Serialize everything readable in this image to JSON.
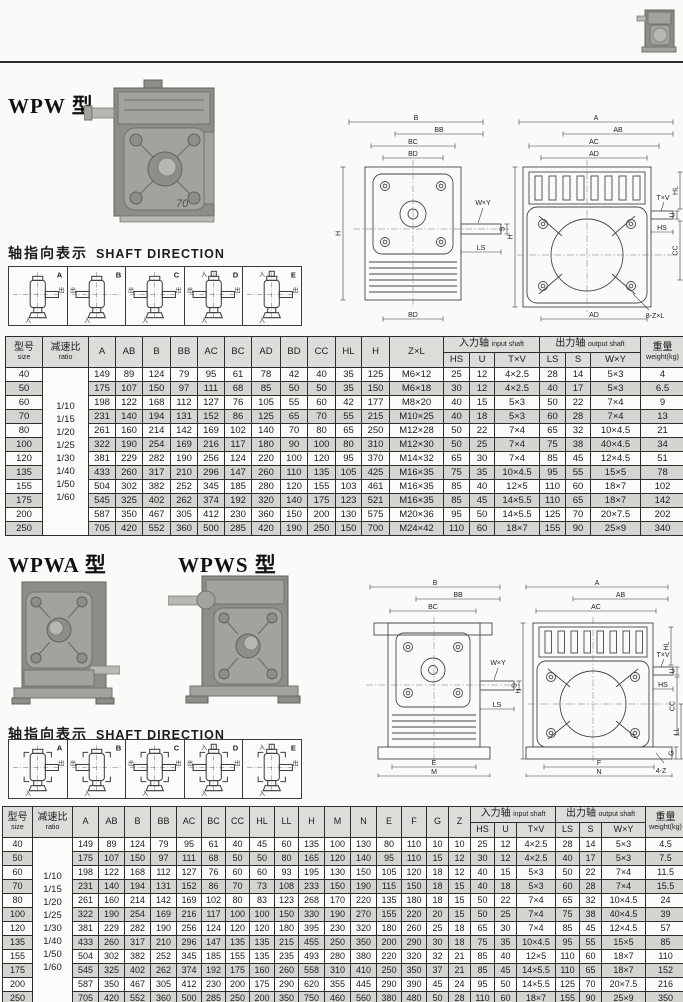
{
  "colors": {
    "paper": "#fafaf8",
    "table_header_bg": "#dcdcd9",
    "row_shaded": "#d4d4d0",
    "line": "#2d2d2d"
  },
  "section1": {
    "title": "WPW 型",
    "photo_badge": "70",
    "shaft_label_cn": "轴指向表示",
    "shaft_label_en": "SHAFT DIRECTION"
  },
  "section2": {
    "title_a": "WPWA 型",
    "title_s": "WPWS 型",
    "shaft_label_cn": "轴指向表示",
    "shaft_label_en": "SHAFT DIRECTION"
  },
  "strips": {
    "in_label": "入",
    "out_label": "出",
    "boxes": [
      {
        "label": "A",
        "out_left": false,
        "out_right": true,
        "in_top": false
      },
      {
        "label": "B",
        "out_left": true,
        "out_right": false,
        "in_top": false
      },
      {
        "label": "C",
        "out_left": true,
        "out_right": true,
        "in_top": false
      },
      {
        "label": "D",
        "out_left": true,
        "out_right": true,
        "in_top": true
      },
      {
        "label": "E",
        "out_left": false,
        "out_right": true,
        "in_top": true
      }
    ]
  },
  "drawing1": {
    "left_dims": [
      "B",
      "BB",
      "BC",
      "BD"
    ],
    "left_bottom": "BD",
    "left_height": "H",
    "shaft_labels": [
      "W×Y",
      "LS",
      "S"
    ],
    "right_dims": [
      "A",
      "AB",
      "AC",
      "AD"
    ],
    "right_bottom": "AD",
    "right_height": "H",
    "input_labels": [
      "T×V",
      "U",
      "HL",
      "HS",
      "CC"
    ],
    "bolt_callout": "8-Z×L"
  },
  "drawing2": {
    "left_dims": [
      "B",
      "BB",
      "BC"
    ],
    "left_base": [
      "E",
      "M"
    ],
    "shaft_labels": [
      "W×Y",
      "LS",
      "S"
    ],
    "right_dims": [
      "A",
      "AB",
      "AC"
    ],
    "right_height": "H",
    "input_labels": [
      "T×V",
      "U",
      "HL",
      "HS",
      "CC"
    ],
    "right_side": [
      "LL",
      "G"
    ],
    "right_base": [
      "F",
      "N"
    ],
    "bolt_callout": "4-Z"
  },
  "table1": {
    "size_header_cn": "型号",
    "size_header_en": "size",
    "ratio_header_cn": "减速比",
    "ratio_header_en": "ratio",
    "col_headers": [
      "A",
      "AB",
      "B",
      "BB",
      "AC",
      "BC",
      "AD",
      "BD",
      "CC",
      "HL",
      "H",
      "Z×L"
    ],
    "input_group_cn": "入力轴",
    "input_group_en": "input shaft",
    "input_cols": [
      "HS",
      "U",
      "T×V"
    ],
    "output_group_cn": "出力轴",
    "output_group_en": "output shaft",
    "output_cols": [
      "LS",
      "S",
      "W×Y"
    ],
    "weight_header_cn": "重量",
    "weight_header_en": "weight(kg)",
    "col_widths": [
      37,
      46,
      27,
      27,
      28,
      27,
      27,
      27,
      29,
      27,
      28,
      26,
      28,
      54,
      26,
      25,
      45,
      26,
      25,
      50,
      44
    ],
    "ratios": [
      "1/10",
      "1/15",
      "1/20",
      "1/25",
      "1/30",
      "1/40",
      "1/50",
      "1/60"
    ],
    "rows": [
      {
        "size": "40",
        "values": [
          "149",
          "89",
          "124",
          "79",
          "95",
          "61",
          "78",
          "42",
          "40",
          "35",
          "125",
          "M6×12",
          "25",
          "12",
          "4×2.5",
          "28",
          "14",
          "5×3",
          "4"
        ]
      },
      {
        "size": "50",
        "values": [
          "175",
          "107",
          "150",
          "97",
          "111",
          "68",
          "85",
          "50",
          "50",
          "35",
          "150",
          "M6×18",
          "30",
          "12",
          "4×2.5",
          "40",
          "17",
          "5×3",
          "6.5"
        ]
      },
      {
        "size": "60",
        "values": [
          "198",
          "122",
          "168",
          "112",
          "127",
          "76",
          "105",
          "55",
          "60",
          "42",
          "177",
          "M8×20",
          "40",
          "15",
          "5×3",
          "50",
          "22",
          "7×4",
          "9"
        ]
      },
      {
        "size": "70",
        "values": [
          "231",
          "140",
          "194",
          "131",
          "152",
          "86",
          "125",
          "65",
          "70",
          "55",
          "215",
          "M10×25",
          "40",
          "18",
          "5×3",
          "60",
          "28",
          "7×4",
          "13"
        ]
      },
      {
        "size": "80",
        "values": [
          "261",
          "160",
          "214",
          "142",
          "169",
          "102",
          "140",
          "70",
          "80",
          "65",
          "250",
          "M12×28",
          "50",
          "22",
          "7×4",
          "65",
          "32",
          "10×4.5",
          "21"
        ]
      },
      {
        "size": "100",
        "values": [
          "322",
          "190",
          "254",
          "169",
          "216",
          "117",
          "180",
          "90",
          "100",
          "80",
          "310",
          "M12×30",
          "50",
          "25",
          "7×4",
          "75",
          "38",
          "40×4.5",
          "34"
        ]
      },
      {
        "size": "120",
        "values": [
          "381",
          "229",
          "282",
          "190",
          "256",
          "124",
          "220",
          "100",
          "120",
          "95",
          "370",
          "M14×32",
          "65",
          "30",
          "7×4",
          "85",
          "45",
          "12×4.5",
          "51"
        ]
      },
      {
        "size": "135",
        "values": [
          "433",
          "260",
          "317",
          "210",
          "296",
          "147",
          "260",
          "110",
          "135",
          "105",
          "425",
          "M16×35",
          "75",
          "35",
          "10×4.5",
          "95",
          "55",
          "15×5",
          "78"
        ]
      },
      {
        "size": "155",
        "values": [
          "504",
          "302",
          "382",
          "252",
          "345",
          "185",
          "280",
          "120",
          "155",
          "103",
          "461",
          "M16×35",
          "85",
          "40",
          "12×5",
          "110",
          "60",
          "18×7",
          "102"
        ]
      },
      {
        "size": "175",
        "values": [
          "545",
          "325",
          "402",
          "262",
          "374",
          "192",
          "320",
          "140",
          "175",
          "123",
          "521",
          "M16×35",
          "85",
          "45",
          "14×5.5",
          "110",
          "65",
          "18×7",
          "142"
        ]
      },
      {
        "size": "200",
        "values": [
          "587",
          "350",
          "467",
          "305",
          "412",
          "230",
          "360",
          "150",
          "200",
          "130",
          "575",
          "M20×36",
          "95",
          "50",
          "14×5.5",
          "125",
          "70",
          "20×7.5",
          "202"
        ]
      },
      {
        "size": "250",
        "values": [
          "705",
          "420",
          "552",
          "360",
          "500",
          "285",
          "420",
          "190",
          "250",
          "150",
          "700",
          "M24×42",
          "110",
          "60",
          "18×7",
          "155",
          "90",
          "25×9",
          "340"
        ]
      }
    ]
  },
  "table2": {
    "size_header_cn": "型号",
    "size_header_en": "size",
    "ratio_header_cn": "减速比",
    "ratio_header_en": "ratio",
    "col_headers": [
      "A",
      "AB",
      "B",
      "BB",
      "AC",
      "BC",
      "CC",
      "HL",
      "LL",
      "H",
      "M",
      "N",
      "E",
      "F",
      "G",
      "Z"
    ],
    "input_group_cn": "入力轴",
    "input_group_en": "input shaft",
    "input_cols": [
      "HS",
      "U",
      "T×V"
    ],
    "output_group_cn": "出力轴",
    "output_group_en": "output shaft",
    "output_cols": [
      "LS",
      "S",
      "W×Y"
    ],
    "weight_header_cn": "重量",
    "weight_header_en": "weight(kg)",
    "col_widths": [
      30,
      40,
      26,
      26,
      26,
      26,
      25,
      24,
      24,
      25,
      24,
      26,
      26,
      26,
      25,
      25,
      22,
      22,
      24,
      22,
      39,
      24,
      22,
      44,
      40
    ],
    "ratios": [
      "1/10",
      "1/15",
      "1/20",
      "1/25",
      "1/30",
      "1/40",
      "1/50",
      "1/60"
    ],
    "rows": [
      {
        "size": "40",
        "values": [
          "149",
          "89",
          "124",
          "79",
          "95",
          "61",
          "40",
          "45",
          "60",
          "135",
          "100",
          "130",
          "80",
          "110",
          "10",
          "10",
          "25",
          "12",
          "4×2.5",
          "28",
          "14",
          "5×3",
          "4.5"
        ]
      },
      {
        "size": "50",
        "values": [
          "175",
          "107",
          "150",
          "97",
          "111",
          "68",
          "50",
          "50",
          "80",
          "165",
          "120",
          "140",
          "95",
          "110",
          "15",
          "12",
          "30",
          "12",
          "4×2.5",
          "40",
          "17",
          "5×3",
          "7.5"
        ]
      },
      {
        "size": "60",
        "values": [
          "198",
          "122",
          "168",
          "112",
          "127",
          "76",
          "60",
          "60",
          "93",
          "195",
          "130",
          "150",
          "105",
          "120",
          "18",
          "12",
          "40",
          "15",
          "5×3",
          "50",
          "22",
          "7×4",
          "11.5"
        ]
      },
      {
        "size": "70",
        "values": [
          "231",
          "140",
          "194",
          "131",
          "152",
          "86",
          "70",
          "73",
          "108",
          "233",
          "150",
          "190",
          "115",
          "150",
          "18",
          "15",
          "40",
          "18",
          "5×3",
          "60",
          "28",
          "7×4",
          "15.5"
        ]
      },
      {
        "size": "80",
        "values": [
          "261",
          "160",
          "214",
          "142",
          "169",
          "102",
          "80",
          "83",
          "123",
          "268",
          "170",
          "220",
          "135",
          "180",
          "18",
          "15",
          "50",
          "22",
          "7×4",
          "65",
          "32",
          "10×4.5",
          "24"
        ]
      },
      {
        "size": "100",
        "values": [
          "322",
          "190",
          "254",
          "169",
          "216",
          "117",
          "100",
          "100",
          "150",
          "330",
          "190",
          "270",
          "155",
          "220",
          "20",
          "15",
          "50",
          "25",
          "7×4",
          "75",
          "38",
          "40×4.5",
          "39"
        ]
      },
      {
        "size": "120",
        "values": [
          "381",
          "229",
          "282",
          "190",
          "256",
          "124",
          "120",
          "120",
          "180",
          "395",
          "230",
          "320",
          "180",
          "260",
          "25",
          "18",
          "65",
          "30",
          "7×4",
          "85",
          "45",
          "12×4.5",
          "57"
        ]
      },
      {
        "size": "135",
        "values": [
          "433",
          "260",
          "317",
          "210",
          "296",
          "147",
          "135",
          "135",
          "215",
          "455",
          "250",
          "350",
          "200",
          "290",
          "30",
          "18",
          "75",
          "35",
          "10×4.5",
          "95",
          "55",
          "15×5",
          "85"
        ]
      },
      {
        "size": "155",
        "values": [
          "504",
          "302",
          "382",
          "252",
          "345",
          "185",
          "155",
          "135",
          "235",
          "493",
          "280",
          "380",
          "220",
          "320",
          "32",
          "21",
          "85",
          "40",
          "12×5",
          "110",
          "60",
          "18×7",
          "110"
        ]
      },
      {
        "size": "175",
        "values": [
          "545",
          "325",
          "402",
          "262",
          "374",
          "192",
          "175",
          "160",
          "260",
          "558",
          "310",
          "410",
          "250",
          "350",
          "37",
          "21",
          "85",
          "45",
          "14×5.5",
          "110",
          "65",
          "18×7",
          "152"
        ]
      },
      {
        "size": "200",
        "values": [
          "587",
          "350",
          "467",
          "305",
          "412",
          "230",
          "200",
          "175",
          "290",
          "620",
          "355",
          "445",
          "290",
          "390",
          "45",
          "24",
          "95",
          "50",
          "14×5.5",
          "125",
          "70",
          "20×7.5",
          "216"
        ]
      },
      {
        "size": "250",
        "values": [
          "705",
          "420",
          "552",
          "360",
          "500",
          "285",
          "250",
          "200",
          "350",
          "750",
          "460",
          "560",
          "380",
          "480",
          "50",
          "28",
          "110",
          "60",
          "18×7",
          "155",
          "90",
          "25×9",
          "350"
        ]
      }
    ]
  }
}
